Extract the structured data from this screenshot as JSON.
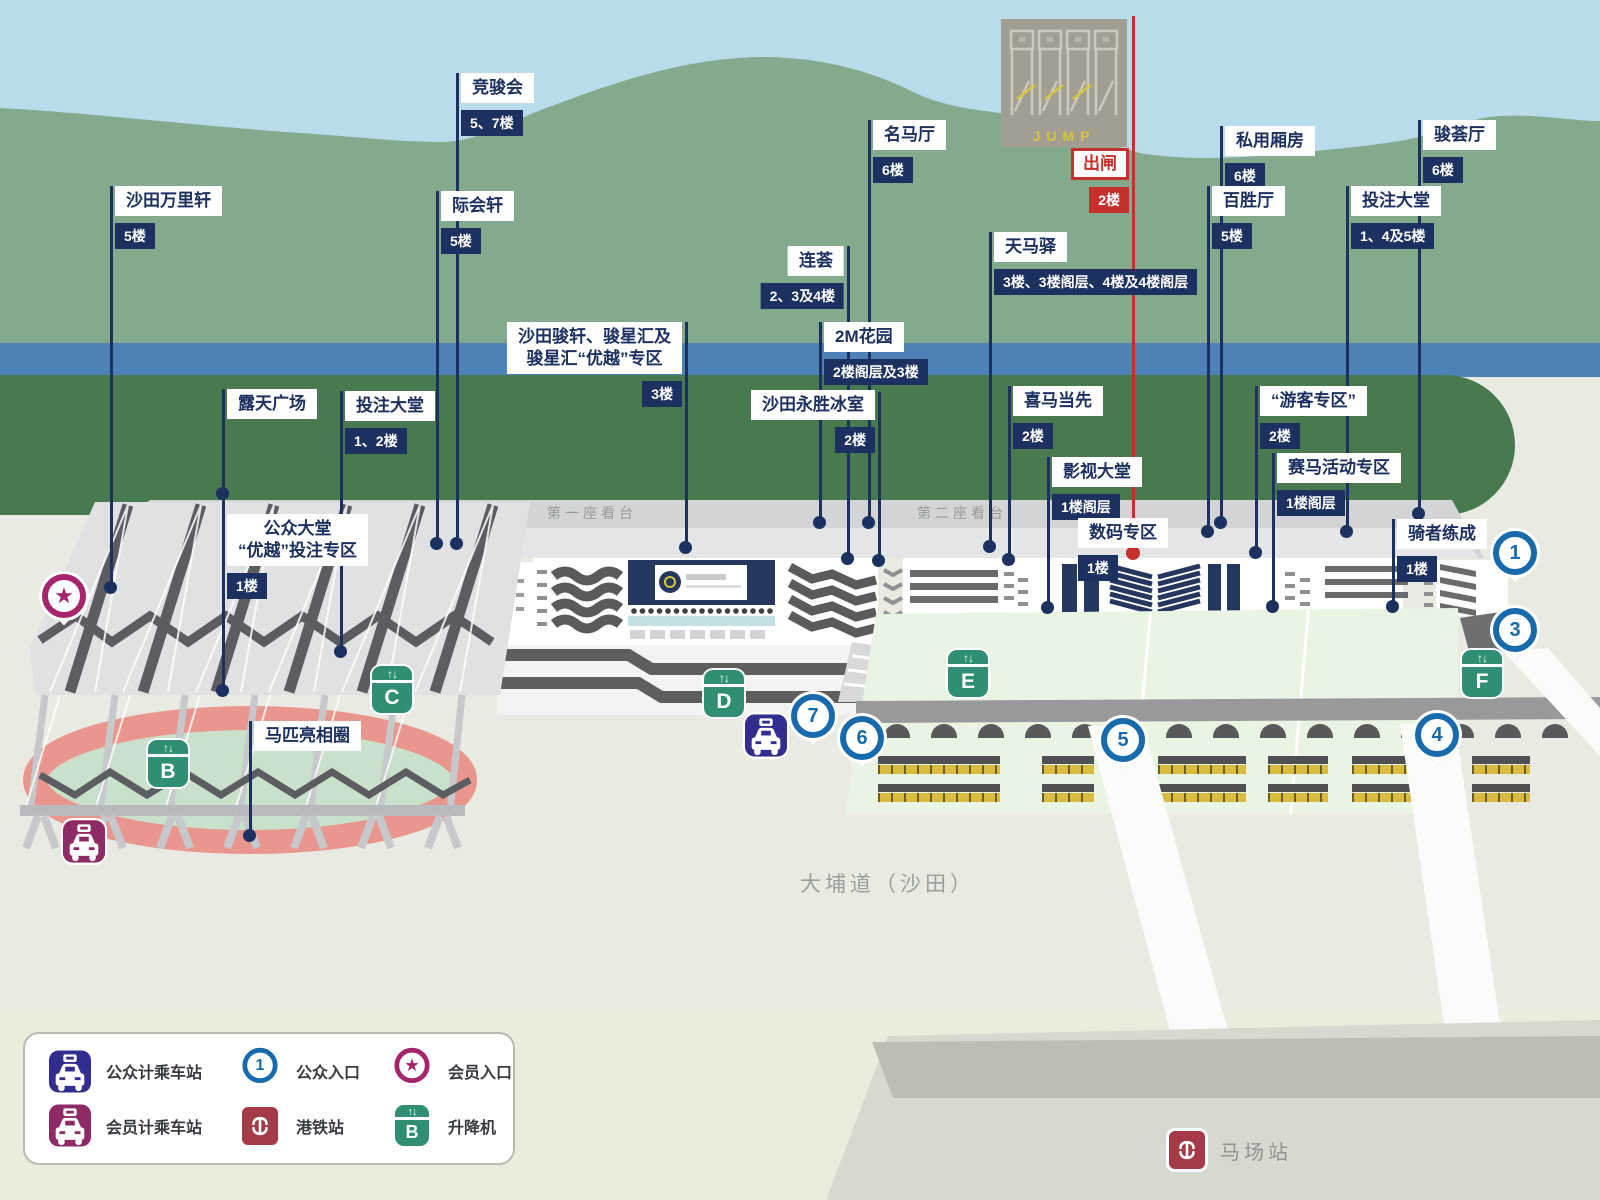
{
  "colors": {
    "navy": "#1d3160",
    "red": "#c4302b",
    "pin_blue": "#176aab",
    "lift_green": "#2f8e74",
    "taxi_public": "#312e8f",
    "taxi_member": "#8e2a66",
    "member_magenta": "#a6246c",
    "mtr_red": "#a53a49",
    "hills": "#83aa8d",
    "river": "#4e82b6",
    "infield_green": "#48794f"
  },
  "map": {
    "jump": {
      "text": "JUMP"
    },
    "stands": {
      "first": "第一座看台",
      "second": "第二座看台"
    },
    "road": "大埔道（沙田）",
    "station": {
      "name": "马场站"
    },
    "labels": [
      {
        "id": "shatin-trackside",
        "title": "沙田万里轩",
        "floor": "5楼",
        "x": 111,
        "boxTop": 186,
        "side": "right",
        "lineTop": 186,
        "lineBottom": 587
      },
      {
        "id": "racing-club",
        "title": "竞骏会",
        "floor": "5、7楼",
        "x": 457,
        "boxTop": 73,
        "side": "right",
        "lineTop": 73,
        "lineBottom": 543
      },
      {
        "id": "gathering-hall",
        "title": "际会轩",
        "floor": "5楼",
        "x": 437,
        "boxTop": 191,
        "side": "right",
        "lineTop": 191,
        "lineBottom": 543
      },
      {
        "id": "hall-of-fame",
        "title": "名马厅",
        "floor": "6楼",
        "x": 869,
        "boxTop": 120,
        "side": "right",
        "lineTop": 120,
        "lineBottom": 522
      },
      {
        "id": "private-boxes",
        "title": "私用厢房",
        "floor": "6楼",
        "x": 1221,
        "boxTop": 126,
        "side": "right",
        "lineTop": 126,
        "lineBottom": 522
      },
      {
        "id": "champions-lounge",
        "title": "骏荟厅",
        "floor": "6楼",
        "x": 1419,
        "boxTop": 120,
        "side": "right",
        "lineTop": 120,
        "lineBottom": 513
      },
      {
        "id": "pak-sing-hall",
        "title": "百胜厅",
        "floor": "5楼",
        "x": 1208,
        "boxTop": 186,
        "side": "right",
        "lineTop": 186,
        "lineBottom": 531
      },
      {
        "id": "betting-hall-east",
        "title": "投注大堂",
        "floor": "1、4及5楼",
        "x": 1347,
        "boxTop": 186,
        "side": "right",
        "lineTop": 186,
        "lineBottom": 531
      },
      {
        "id": "starting-gate",
        "variant": "red",
        "title": "出闸",
        "floor": "2楼",
        "x": 1133,
        "boxTop": 148,
        "side": "left",
        "lineTop": 16,
        "lineBottom": 552
      },
      {
        "id": "the-terrace",
        "title": "连荟",
        "floor": "2、3及4楼",
        "x": 848,
        "boxTop": 246,
        "side": "left",
        "lineTop": 246,
        "lineBottom": 558
      },
      {
        "id": "pegasus-stop",
        "title": "天马驿",
        "floor": "3楼、3楼阁层、4楼及4楼阁层",
        "x": 990,
        "boxTop": 232,
        "side": "right",
        "lineTop": 232,
        "lineBottom": 546
      },
      {
        "id": "2m-garden",
        "title": "2M花园",
        "floor": "2楼阁层及3楼",
        "x": 820,
        "boxTop": 322,
        "side": "right",
        "lineTop": 322,
        "lineBottom": 522
      },
      {
        "id": "shatin-junxuan",
        "title": "沙田骏轩、骏星汇及",
        "title2": "骏星汇“优越”专区",
        "floor": "3楼",
        "x": 686,
        "boxTop": 322,
        "side": "left",
        "lineTop": 322,
        "lineBottom": 547
      },
      {
        "id": "wing-sing-cafe",
        "title": "沙田永胜冰室",
        "floor": "2楼",
        "x": 879,
        "boxTop": 390,
        "side": "left",
        "lineTop": 392,
        "lineBottom": 560
      },
      {
        "id": "hi-ma-first",
        "title": "喜马当先",
        "floor": "2楼",
        "x": 1009,
        "boxTop": 386,
        "side": "right",
        "lineTop": 386,
        "lineBottom": 559
      },
      {
        "id": "visitors-zone",
        "title": "“游客专区”",
        "floor": "2楼",
        "x": 1256,
        "boxTop": 386,
        "side": "right",
        "lineTop": 386,
        "lineBottom": 552
      },
      {
        "id": "tv-hall",
        "title": "影视大堂",
        "floor": "1楼阁层",
        "x": 1048,
        "boxTop": 457,
        "side": "right",
        "lineTop": 457,
        "lineBottom": 607
      },
      {
        "id": "racing-activity-zone",
        "title": "赛马活动专区",
        "floor": "1楼阁层",
        "x": 1273,
        "boxTop": 453,
        "side": "right",
        "lineTop": 453,
        "lineBottom": 606
      },
      {
        "id": "digital-zone",
        "title": "数码专区",
        "floor": "1楼",
        "x": 1133,
        "boxTop": 518,
        "side": "free",
        "boxLeft": 1078,
        "noLine": true
      },
      {
        "id": "riding-high",
        "title": "骑者练成",
        "floor": "1楼",
        "x": 1393,
        "boxTop": 519,
        "side": "right",
        "lineTop": 519,
        "lineBottom": 606
      },
      {
        "id": "open-plaza",
        "title": "露天广场",
        "floor": null,
        "x": 223,
        "boxTop": 389,
        "side": "right",
        "lineTop": 389,
        "lineBottom": 493
      },
      {
        "id": "betting-hall-west",
        "title": "投注大堂",
        "floor": "1、2楼",
        "x": 341,
        "boxTop": 391,
        "side": "right",
        "lineTop": 391,
        "lineBottom": 651
      },
      {
        "id": "public-hall",
        "title": "公众大堂",
        "title2": "“优越”投注专区",
        "floor": "1楼",
        "x": 223,
        "boxTop": 514,
        "side": "right",
        "lineTop": 493,
        "lineBottom": 690
      },
      {
        "id": "parade-ring",
        "title": "马匹亮相圈",
        "floor": null,
        "x": 250,
        "boxTop": 721,
        "side": "right",
        "lineTop": 721,
        "lineBottom": 835
      }
    ],
    "pins": [
      {
        "n": "1",
        "x": 1515,
        "y": 553
      },
      {
        "n": "3",
        "x": 1515,
        "y": 630
      },
      {
        "n": "4",
        "x": 1437,
        "y": 735
      },
      {
        "n": "5",
        "x": 1123,
        "y": 740
      },
      {
        "n": "6",
        "x": 862,
        "y": 738
      },
      {
        "n": "7",
        "x": 813,
        "y": 716
      }
    ],
    "lifts": [
      {
        "letter": "B",
        "x": 148,
        "y": 740
      },
      {
        "letter": "C",
        "x": 372,
        "y": 666
      },
      {
        "letter": "D",
        "x": 704,
        "y": 670
      },
      {
        "letter": "E",
        "x": 948,
        "y": 650
      },
      {
        "letter": "F",
        "x": 1462,
        "y": 650
      }
    ],
    "taxis": [
      {
        "type": "public",
        "x": 745,
        "y": 714
      },
      {
        "type": "member",
        "x": 63,
        "y": 820
      }
    ],
    "member_entrance": {
      "x": 64,
      "y": 596,
      "symbol": "★"
    }
  },
  "legend": {
    "items": [
      {
        "icon": "taxi-public",
        "label": "公众计乘车站"
      },
      {
        "icon": "entrance-pin",
        "label": "公众入口",
        "pin_number": "1"
      },
      {
        "icon": "member-pin",
        "label": "会员入口"
      },
      {
        "icon": "taxi-member",
        "label": "会员计乘车站"
      },
      {
        "icon": "mtr",
        "label": "港铁站"
      },
      {
        "icon": "lift",
        "label": "升降机",
        "lift_letter": "B"
      }
    ]
  }
}
